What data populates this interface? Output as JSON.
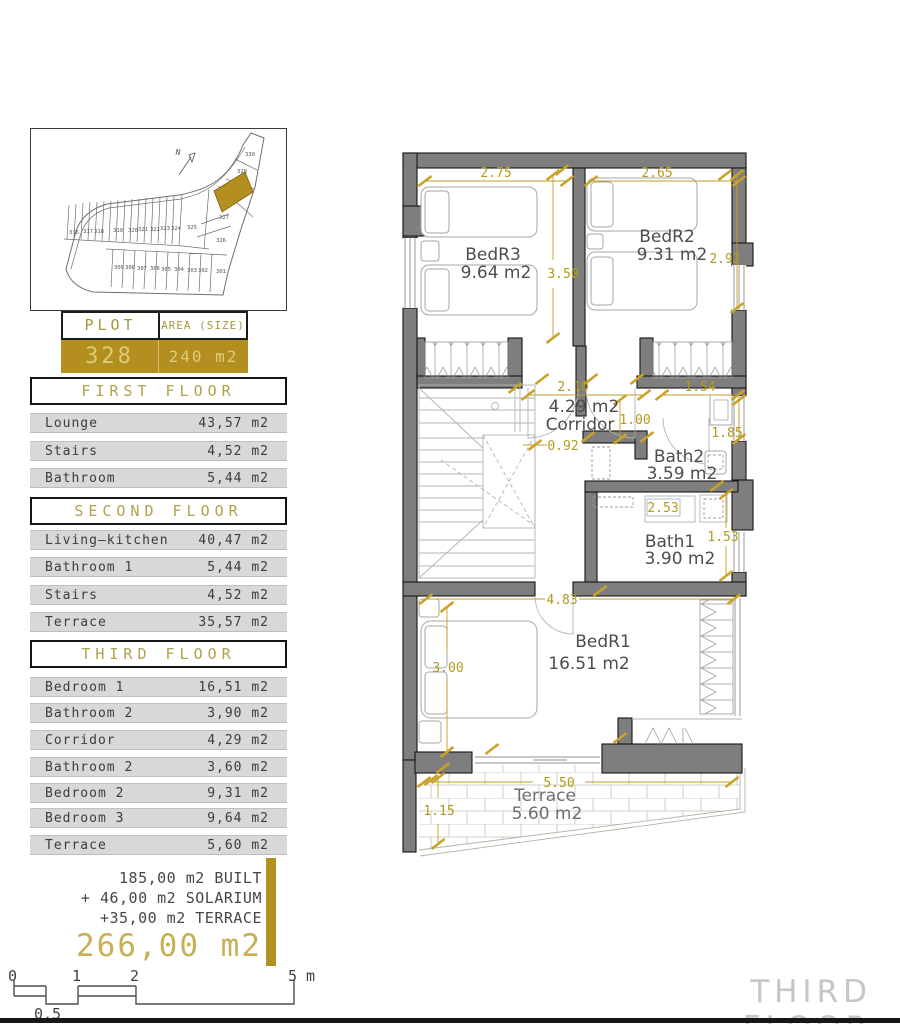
{
  "site": {
    "north": "N",
    "highlighted_plot": "328",
    "plots": [
      "330",
      "329",
      "327",
      "326",
      "325",
      "316",
      "317",
      "318",
      "319",
      "320",
      "321",
      "322",
      "323",
      "324",
      "309",
      "308",
      "307",
      "306",
      "305",
      "304",
      "303",
      "302",
      "301"
    ]
  },
  "plot_table": {
    "col1_header": "PLOT",
    "col2_header": "AREA (SIZE)",
    "plot_number": "328",
    "area": "240 m2"
  },
  "floors": [
    {
      "title": "FIRST FLOOR",
      "rows": [
        {
          "label": "Lounge",
          "value": "43,57 m2"
        },
        {
          "label": "Stairs",
          "value": "4,52 m2"
        },
        {
          "label": "Bathroom",
          "value": "5,44 m2"
        }
      ]
    },
    {
      "title": "SECOND FLOOR",
      "rows": [
        {
          "label": "Living—kitchen",
          "value": "40,47 m2"
        },
        {
          "label": "Bathroom 1",
          "value": "5,44 m2"
        },
        {
          "label": "Stairs",
          "value": "4,52 m2"
        },
        {
          "label": "Terrace",
          "value": "35,57 m2"
        }
      ]
    },
    {
      "title": "THIRD FLOOR",
      "rows": [
        {
          "label": "Bedroom 1",
          "value": "16,51 m2"
        },
        {
          "label": "Bathroom 2",
          "value": "3,90 m2"
        },
        {
          "label": "Corridor",
          "value": "4,29 m2"
        },
        {
          "label": "Bathroom 2",
          "value": "3,60 m2"
        },
        {
          "label": "Bedroom 2",
          "value": "9,31 m2"
        },
        {
          "label": "Bedroom 3",
          "value": "9,64 m2"
        },
        {
          "label": "Terrace",
          "value": "5,60 m2"
        }
      ]
    }
  ],
  "summary": {
    "line1": "185,00 m2 BUILT",
    "line2": "+ 46,00 m2 SOLARIUM",
    "line3": "+35,00 m2 TERRACE",
    "total": "266,00 m2"
  },
  "scale_bar": {
    "t0": "0",
    "t1": "1",
    "t2": "2",
    "t5": "5 m",
    "t05": "0,5"
  },
  "plan": {
    "rooms": {
      "bedr3": {
        "name": "BedR3",
        "area": "9.64 m2"
      },
      "bedr2": {
        "name": "BedR2",
        "area": "9.31 m2"
      },
      "corridor": {
        "area": "4.29 m2",
        "name": "Corridor"
      },
      "bath2": {
        "name": "Bath2",
        "area": "3.59 m2"
      },
      "bath1": {
        "name": "Bath1",
        "area": "3.90 m2"
      },
      "bedr1": {
        "name": "BedR1",
        "area": "16.51 m2"
      },
      "terrace": {
        "name": "Terrace",
        "area": "5.60 m2"
      }
    },
    "dims": {
      "d275": "2.75",
      "d265": "2.65",
      "d350": "3.50",
      "d292": "2.92",
      "d210": "2.10",
      "d100": "1.00",
      "d154": "1.54",
      "d092": "0.92",
      "d185": "1.85",
      "d253": "2.53",
      "d153": "1.53",
      "d483": "4.83",
      "d300": "3.00",
      "d550": "5.50",
      "d115": "1.15"
    }
  },
  "page_title": "THIRD FLOOR",
  "colors": {
    "gold": "#b28f1e",
    "dim_gold": "#b49a1a",
    "wall_gray": "#7e7e7e"
  }
}
